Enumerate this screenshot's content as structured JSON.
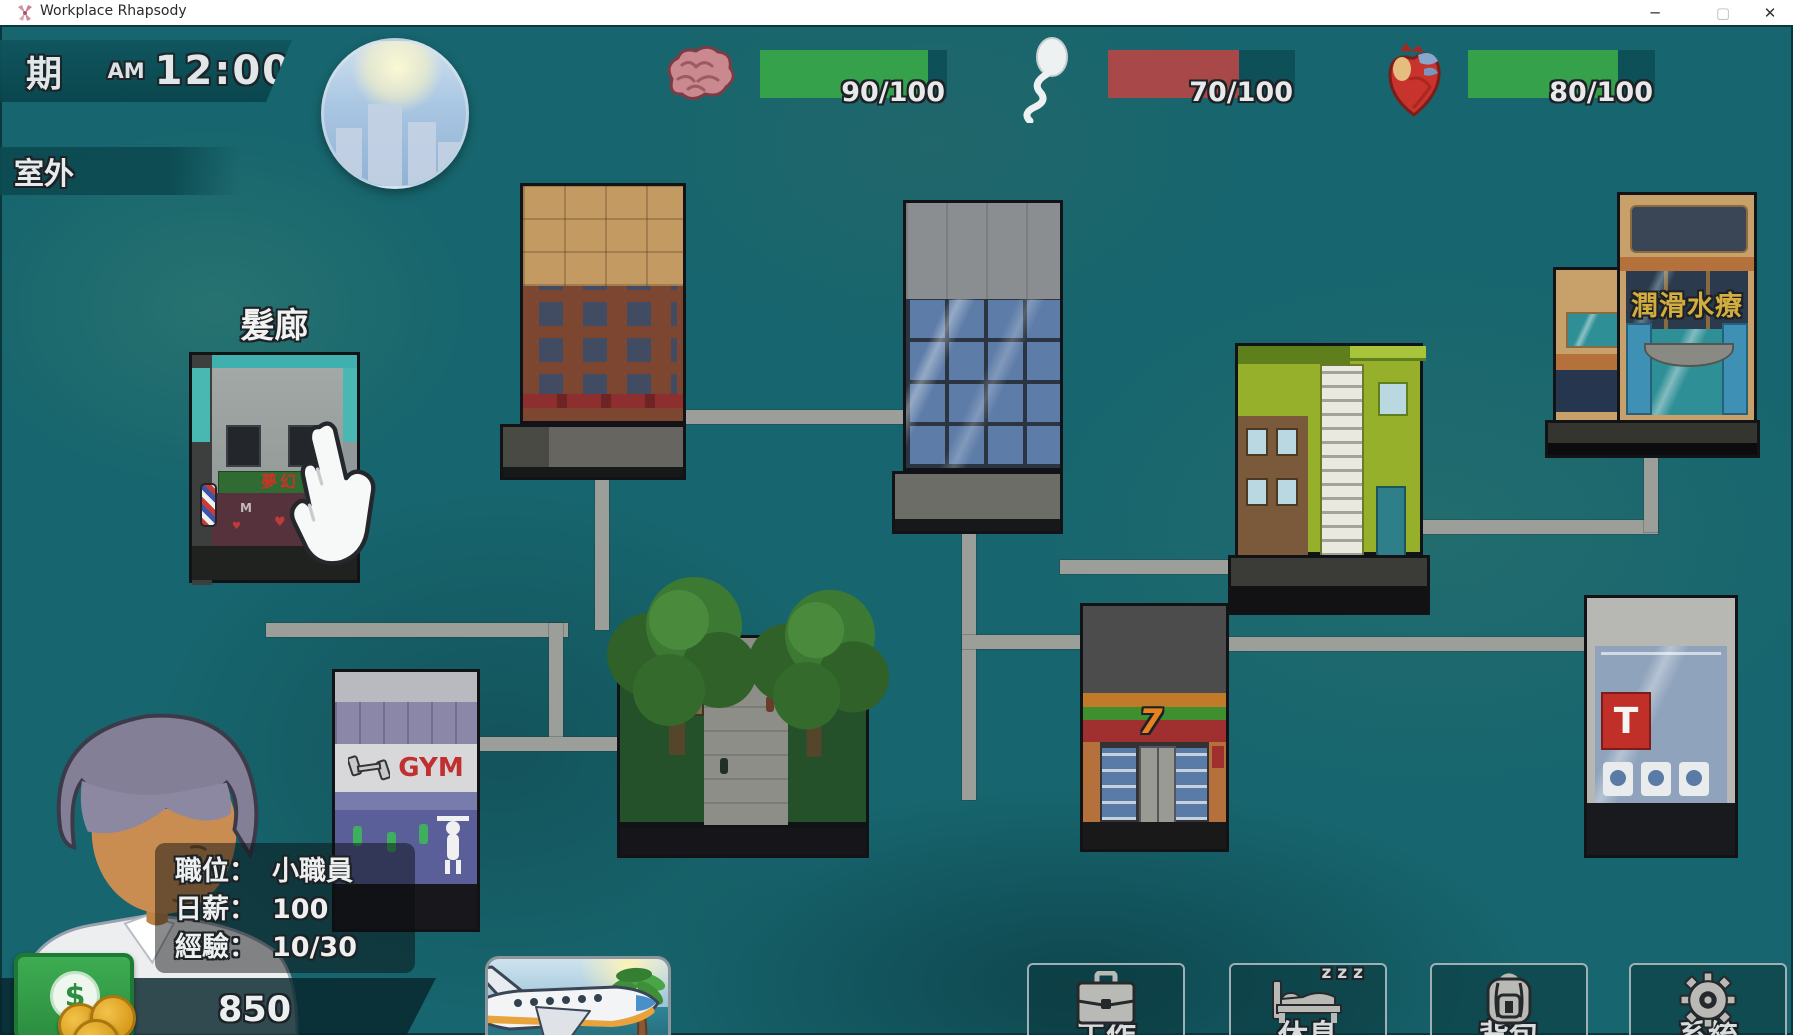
{
  "window": {
    "title": "Workplace Rhapsody",
    "minimize": "─",
    "maximize": "▢",
    "close": "✕"
  },
  "hud": {
    "day": "星期一",
    "meridiem": "AM",
    "time": "12:00",
    "location": "室外",
    "stats": [
      {
        "name": "intelligence",
        "icon": "brain-icon",
        "label": "90/100",
        "value": 90,
        "max": 100,
        "pct": 90,
        "fill_color": "#36a14b"
      },
      {
        "name": "vitality",
        "icon": "sperm-icon",
        "label": "70/100",
        "value": 70,
        "max": 100,
        "pct": 70,
        "fill_color": "#a84848"
      },
      {
        "name": "health",
        "icon": "heart-icon",
        "label": "80/100",
        "value": 80,
        "max": 100,
        "pct": 80,
        "fill_color": "#36a14b"
      }
    ]
  },
  "map": {
    "hovered_building_label": "髮廊",
    "salon_sign_text": "夢幻",
    "spa_sign_text": "潤滑水療",
    "gym_sign_text": "GYM",
    "store_seven_text": "7",
    "tstore_sign_text": "T",
    "bed_zzz": "z z z"
  },
  "player": {
    "info": [
      {
        "label": "職位：",
        "value": "小職員"
      },
      {
        "label": "日薪：",
        "value": "100"
      },
      {
        "label": "經驗：",
        "value": "10/30"
      }
    ],
    "money": "850",
    "dollar_symbol": "$"
  },
  "actions": [
    {
      "id": "work",
      "label": "工作",
      "icon": "briefcase-icon"
    },
    {
      "id": "rest",
      "label": "休息",
      "icon": "bed-icon"
    },
    {
      "id": "bag",
      "label": "背包",
      "icon": "backpack-icon"
    },
    {
      "id": "system",
      "label": "系統",
      "icon": "gear-icon"
    }
  ],
  "colors": {
    "bar_green": "#36a14b",
    "bar_red": "#a84848",
    "bar_empty": "#0e5058",
    "background_teal": "#17656e",
    "path_gray": "#9c9e9a"
  }
}
